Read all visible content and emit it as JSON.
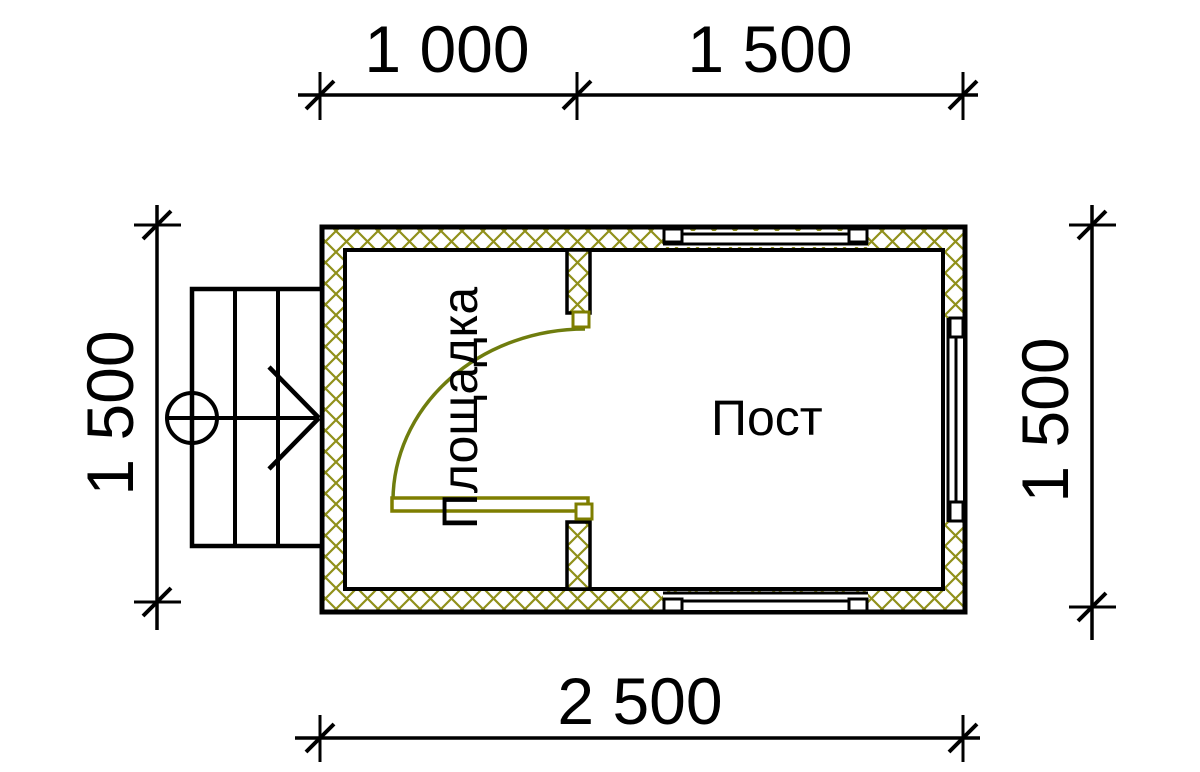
{
  "drawing": {
    "type": "floor-plan",
    "rooms": [
      {
        "name": "Площадка"
      },
      {
        "name": "Пост"
      }
    ],
    "dimensions": {
      "top": [
        "1 000",
        "1 500"
      ],
      "bottom": [
        "2 500"
      ],
      "left": [
        "1 500"
      ],
      "right": [
        "1 500"
      ]
    },
    "watermark": {
      "text": "VANDA"
    },
    "colors": {
      "line": "#000000",
      "hatch": "#90901a",
      "joinery": "#7e7e00",
      "door_arc": "#6f7d0e",
      "watermark_pink": "#f6cad2",
      "watermark_pink_light": "#fadee3",
      "watermark_pink_dark": "#edb6c1",
      "watermark_blue": "#d5e7f3",
      "watermark_blue_mid": "#aecbe3",
      "watermark_blue_light": "#e1edf7"
    }
  }
}
